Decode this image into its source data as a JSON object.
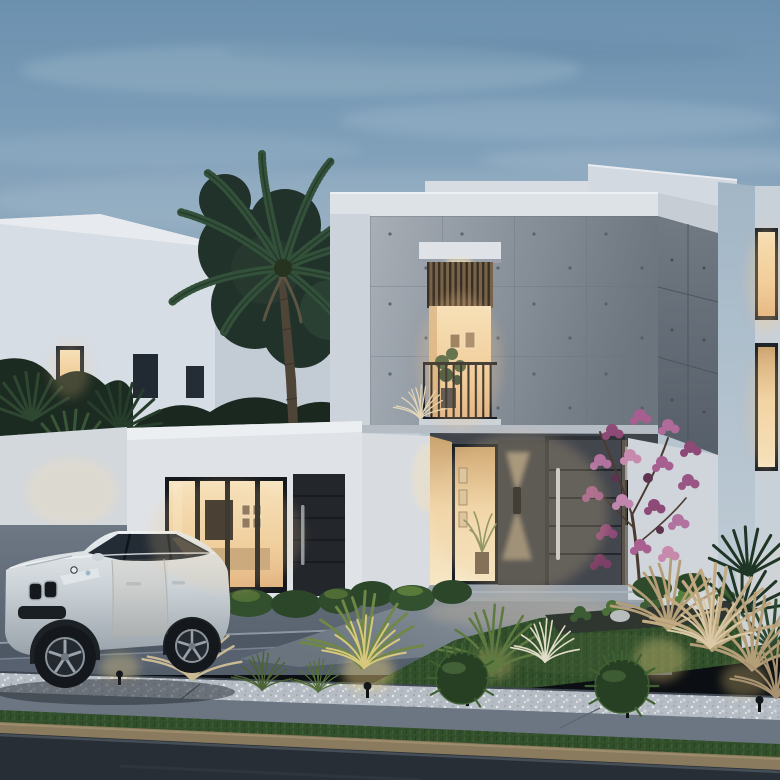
{
  "scene": {
    "type": "architectural-exterior-render",
    "caption": "Twilight 3D rendering of a modern two-storey villa with a board-formed concrete upper facade and white walls, warm-lit interiors, a recessed entrance with a dark pivot door and up/down wall sconce, a Juliet balcony window, a white luxury SUV parked on the driveway, a tall palm tree, a pink flowering tree, ornamental grasses, gravel beds, lawn, sidewalk and street in the foreground",
    "time_of_day": "dusk",
    "objects": {
      "sky": "overcast dusk sky with soft clouds",
      "background_building": "white two-storey neighbour block with dark and warm-lit windows",
      "palm_tree": "tall palm in front of background building",
      "villa": "modern two-storey villa, concrete panel upper floor over white ground floor",
      "balcony": "recessed balcony window with wood louvres, black railing and potted plant",
      "entrance": "recessed porch with warm light, sidelight glass, wall sconce and dark pivot door",
      "glass_doors": "four-panel glass sliding door showing warm living room",
      "side_door": "dark secondary panel door with vertical handle",
      "suv": "white luxury SUV parked facing left on the driveway",
      "flowering_tree": "pink-purple flowering ornamental tree beside the entrance",
      "landscape": "lawn patches, round shrubs, grass tufts, pampas grass, white pebble gravel, spike lights",
      "street": "sidewalk, grass verge, stone curb and dark asphalt road"
    },
    "palette": {
      "sky_top": "#6b90ae",
      "sky_horizon": "#bac7d0",
      "concrete": "#99a1aa",
      "concrete_shadow": "#5d656f",
      "villa_white": "#dfe3e7",
      "warm_light": "#f2d5a4",
      "door_dark": "#3c4046",
      "foliage_dark": "#1f3028",
      "foliage_light": "#5d7a3c",
      "flower_pink": "#b272a0",
      "lawn": "#33502c",
      "gravel": "#b7bec6",
      "driveway": "#5d6874",
      "road": "#272e36",
      "curb": "#8a7a5e",
      "car_body": "#dce1e5"
    }
  }
}
